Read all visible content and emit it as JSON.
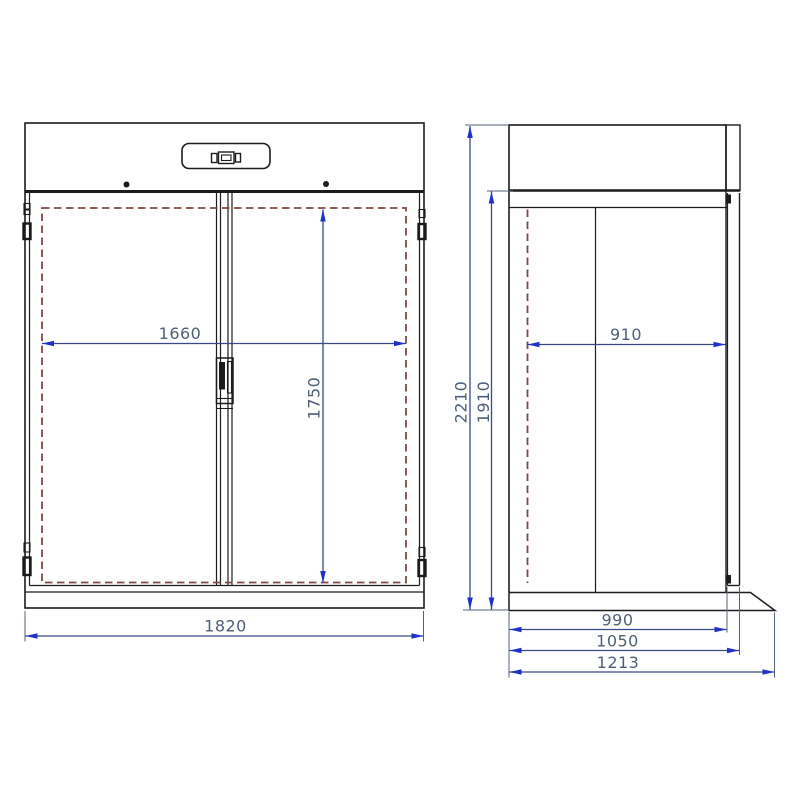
{
  "front_view": {
    "interior_width_label": "1660",
    "interior_height_label": "1750",
    "overall_width_label": "1820"
  },
  "side_view": {
    "overall_height_label": "2210",
    "body_height_label": "1910",
    "interior_depth_label": "910",
    "body_depth_label": "990",
    "depth_with_door_label": "1050",
    "overall_depth_label": "1213"
  },
  "colors": {
    "line": "#1c1c1c",
    "dim_line": "#3a4788",
    "arrow": "#2031c9",
    "extension_line": "#55607a",
    "dashed_interior": "#7d4a45",
    "dim_text": "#4e5f78",
    "background": "#ffffff"
  }
}
